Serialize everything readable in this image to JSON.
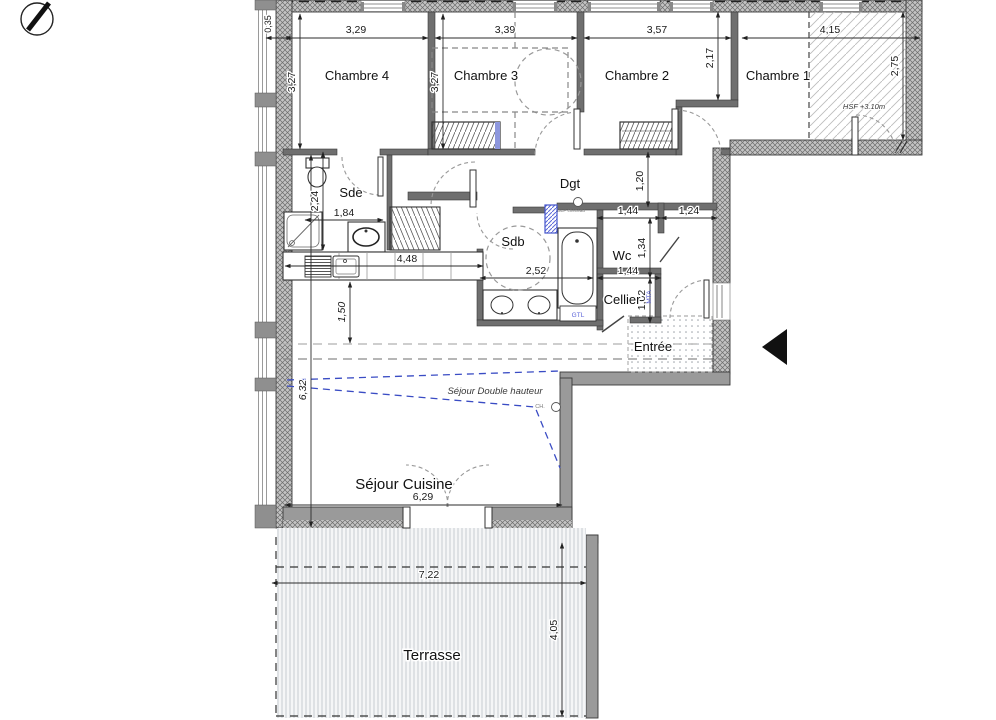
{
  "icons": {
    "north": "north-arrow-icon",
    "entrance": "entrance-arrow-icon"
  },
  "rooms": {
    "chambre4": "Chambre 4",
    "chambre3": "Chambre 3",
    "chambre2": "Chambre 2",
    "chambre1": "Chambre 1",
    "sde": "Sde",
    "dgt": "Dgt",
    "sdb": "Sdb",
    "wc": "Wc",
    "cellier": "Cellier",
    "entree": "Entrée",
    "sejour": "Séjour Cuisine",
    "terrasse": "Terrasse"
  },
  "annotations": {
    "hsf": "HSF +3.10m",
    "double_height": "Séjour Double hauteur",
    "gtl": "GTL",
    "mta": "MTA",
    "ch": "CH.",
    "dep": "DEP chéneau"
  },
  "dimensions": {
    "wall_thickness": "0,35",
    "chambre4_width": "3,29",
    "chambre3_width": "3,39",
    "chambre2_width": "3,57",
    "chambre1_width": "4,15",
    "chambre4_depth": "3,27",
    "chambre3_depth": "3,27",
    "chambre1_left_depth": "2,17",
    "loggia_depth": "2,75",
    "sde_depth": "2,24",
    "shower_width": "1,84",
    "wardrobe_hall_gap": "1,20",
    "wc_width": "1,44",
    "hall_width": "1,24",
    "wc_depth": "1,34",
    "kitchen_width": "4,48",
    "sdb_width": "2,52",
    "cellier_width": "1,44",
    "cellier_depth": "1,02",
    "counter_offset": "1,50",
    "sejour_depth": "6,32",
    "sejour_width": "6,29",
    "terrasse_width": "7,22",
    "terrasse_depth": "4,05"
  }
}
